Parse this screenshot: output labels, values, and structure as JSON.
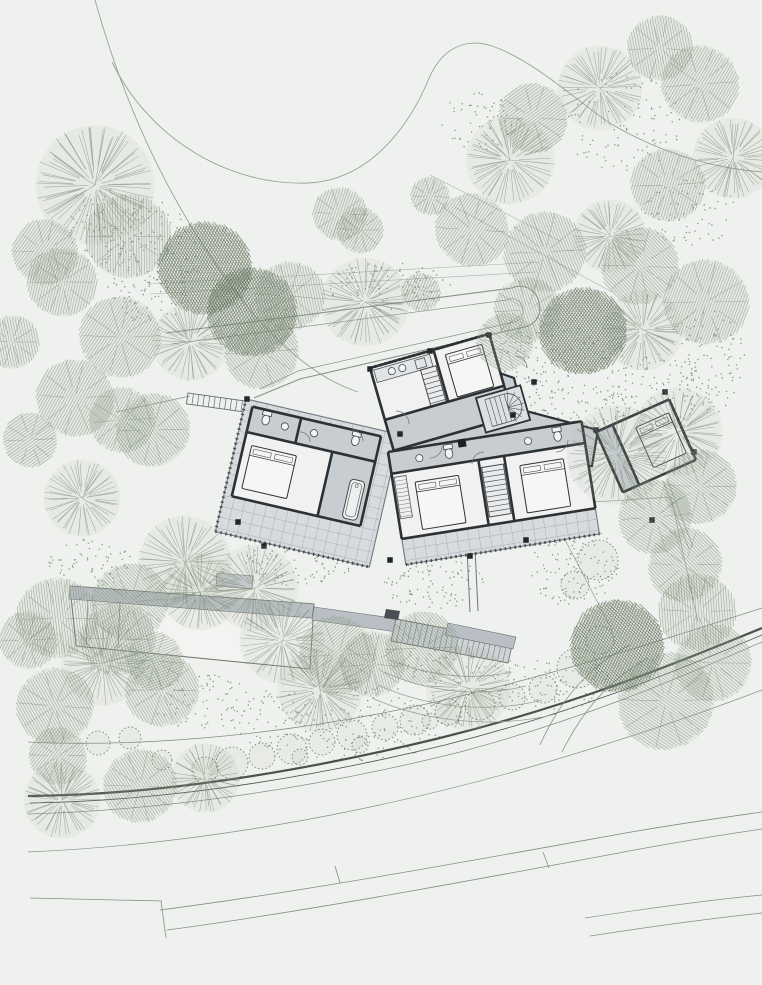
{
  "canvas": {
    "width": 762,
    "height": 985
  },
  "palette": {
    "background": "#eff1ee",
    "tree_line": "#72816e",
    "tree_dark": "#55654f",
    "tree_fill": "#aebaa8",
    "dot": "#5d6d5b",
    "contour": "#9aa09a",
    "path_line": "#8b918b",
    "road_dark": "#4b514b",
    "road_light": "#878d87",
    "wall": "#2d3134",
    "floor_white": "#f0f1f0",
    "hall_gray": "#c7cdd1",
    "terrace": "#d7dbde",
    "terrace_line": "#a7aeb3",
    "roof_gray": "#b9bfc4",
    "outline": "#6b716b"
  },
  "contours": [
    "M 95,0 C 120,90 165,205 250,310 C 288,354 322,380 358,392",
    "M 112,62 C 150,140 230,186 308,183 C 368,180 408,130 430,76 C 444,46 468,38 492,46 C 532,60 570,95 608,122 C 658,152 710,168 762,172"
  ],
  "upper_lines": [
    "M 150,284 L 540,262",
    "M 150,294 L 536,272",
    "M 430,175 L 562,242",
    "M 455,207 L 612,292"
  ],
  "driveway": {
    "outer": "M 166,333 L 512,288 A 19 19 0 0 1 539,305 L 540,309 A 19 19 0 0 1 524,327 L 300,379 L 254,398",
    "inner": "M 172,344 L 507,300 A 11 11 0 0 1 523,310 L 523,313 A 11 11 0 0 1 514,322 L 298,371 L 260,389"
  },
  "roads": [
    {
      "d": "M 28,742 C 150,748 300,733 440,701 C 560,673 660,641 762,608",
      "w": 0.8,
      "c": "road_light"
    },
    {
      "d": "M 28,796 C 160,795 300,772 440,738 C 570,706 670,666 762,628",
      "w": 2.2,
      "c": "road_dark"
    },
    {
      "d": "M 30,803 C 162,801 305,779 445,745 C 572,713 672,673 762,635",
      "w": 0.8,
      "c": "road_dark"
    },
    {
      "d": "M 28,814 C 170,810 320,787 460,752 C 580,720 675,680 762,642",
      "w": 0.7,
      "c": "road_light"
    },
    {
      "d": "M 28,852 C 190,845 360,815 520,770 C 635,737 715,708 762,690",
      "w": 0.7,
      "c": "road_light"
    },
    {
      "d": "M 160,910 C 300,892 470,861 620,834 C 670,825 720,818 762,812",
      "w": 0.8,
      "c": "road_light"
    },
    {
      "d": "M 167,930 C 310,911 490,877 640,849 C 695,839 735,833 762,829",
      "w": 0.8,
      "c": "road_light"
    },
    {
      "d": "M 30,898 L 162,901",
      "w": 0.8,
      "c": "road_light"
    },
    {
      "d": "M 161,901 L 166,938",
      "w": 0.8,
      "c": "road_light"
    },
    {
      "d": "M 335,866 L 340,883",
      "w": 0.8,
      "c": "road_light"
    },
    {
      "d": "M 543,852 L 549,868",
      "w": 0.8,
      "c": "road_light"
    },
    {
      "d": "M 585,918 C 650,908 710,900 762,895",
      "w": 0.7,
      "c": "road_light"
    },
    {
      "d": "M 590,936 C 655,926 715,918 762,913",
      "w": 0.7,
      "c": "road_light"
    },
    {
      "d": "M 540,745 C 560,700 590,665 630,645",
      "w": 0.8,
      "c": "road_light"
    },
    {
      "d": "M 562,752 C 582,712 608,680 648,658",
      "w": 0.8,
      "c": "road_light"
    }
  ],
  "boundary_lines": [
    "M 547,505 L 612,630",
    "M 671,497 L 698,622",
    "M 547,505 L 671,497",
    "M 663,481 L 689,549",
    "M 667,479 L 693,547"
  ],
  "terrace_contours": [
    "M 390,660 C 430,676 470,681 512,672",
    "M 384,672 C 430,693 482,697 526,686",
    "M 378,685 C 430,709 492,713 542,700",
    "M 372,698 C 430,724 500,728 556,714"
  ],
  "lower_building": {
    "body": [
      [
        70,
        586
      ],
      [
        314,
        604
      ],
      [
        310,
        669
      ],
      [
        76,
        646
      ]
    ],
    "roof_band": [
      [
        70,
        586
      ],
      [
        314,
        604
      ],
      [
        312,
        618
      ],
      [
        69,
        599
      ]
    ],
    "notch": [
      [
        217,
        573
      ],
      [
        253,
        576
      ],
      [
        252,
        589
      ],
      [
        216,
        586
      ]
    ],
    "link_band": [
      [
        314,
        607
      ],
      [
        399,
        619
      ],
      [
        397,
        632
      ],
      [
        312,
        620
      ]
    ],
    "dividers": [
      "M 88,600 L 86,645",
      "M 120,602 L 118,648"
    ]
  },
  "stair_terrace": {
    "grid_poly": [
      [
        396,
        619
      ],
      [
        513,
        641
      ],
      [
        508,
        663
      ],
      [
        391,
        641
      ]
    ],
    "band": [
      [
        448,
        623
      ],
      [
        516,
        637
      ],
      [
        513,
        649
      ],
      [
        445,
        635
      ]
    ],
    "wall": [
      [
        386,
        609
      ],
      [
        400,
        611
      ],
      [
        398,
        620
      ],
      [
        384,
        618
      ]
    ],
    "steps": 22
  },
  "link_path": [
    "M 467,549 L 470,612",
    "M 475,548 L 478,611"
  ],
  "walkway": {
    "x": 188,
    "y": 393,
    "rot": 8,
    "w": 64,
    "h": 11,
    "step": 5.5,
    "lead": "M 116,412 L 190,396"
  },
  "building": {
    "hall": [
      [
        392,
        398
      ],
      [
        468,
        362
      ],
      [
        514,
        378
      ],
      [
        522,
        410
      ],
      [
        598,
        430
      ],
      [
        592,
        466
      ],
      [
        470,
        472
      ],
      [
        406,
        454
      ]
    ],
    "wings": [
      {
        "name": "west-wing",
        "ox": 246,
        "oy": 399,
        "rot": 13,
        "terrace": {
          "x": 0,
          "y": 0,
          "w": 158,
          "h": 136,
          "grid": 11
        },
        "rooms": [
          {
            "x": 8,
            "y": 6,
            "w": 132,
            "h": 92,
            "fill": "floor_white"
          },
          {
            "x": 8,
            "y": 6,
            "w": 132,
            "h": 26,
            "fill": "hall_gray"
          },
          {
            "x": 96,
            "y": 32,
            "w": 44,
            "h": 66,
            "fill": "hall_gray"
          }
        ],
        "walls": [
          [
            8,
            6,
            140,
            6
          ],
          [
            8,
            6,
            8,
            98
          ],
          [
            8,
            98,
            140,
            98
          ],
          [
            140,
            6,
            140,
            98
          ],
          [
            8,
            32,
            140,
            32
          ],
          [
            96,
            32,
            96,
            98
          ],
          [
            58,
            6,
            58,
            32
          ]
        ],
        "furn": [
          {
            "t": "bed",
            "x": 16,
            "y": 44,
            "w": 46,
            "h": 44
          },
          {
            "t": "tub",
            "x": 120,
            "y": 54,
            "w": 15,
            "h": 40
          },
          {
            "t": "wc",
            "x": 24,
            "y": 16
          },
          {
            "t": "sink",
            "x": 44,
            "y": 18
          },
          {
            "t": "sink",
            "x": 74,
            "y": 18
          },
          {
            "t": "wc",
            "x": 116,
            "y": 16
          }
        ],
        "ticks": "M 0,0 L 0,136 M 0,136 L 158,136"
      },
      {
        "name": "north-wing",
        "ox": 370,
        "oy": 368,
        "rot": -16,
        "rooms": [
          {
            "x": 0,
            "y": 0,
            "w": 124,
            "h": 86,
            "fill": "floor_white"
          },
          {
            "x": 0,
            "y": 54,
            "w": 124,
            "h": 32,
            "fill": "hall_gray"
          }
        ],
        "walls": [
          [
            0,
            0,
            124,
            0
          ],
          [
            0,
            0,
            0,
            86
          ],
          [
            124,
            0,
            124,
            86
          ],
          [
            0,
            86,
            124,
            86
          ],
          [
            66,
            0,
            66,
            54
          ],
          [
            0,
            54,
            124,
            54
          ]
        ],
        "furn": [
          {
            "t": "counter",
            "x": 3,
            "y": 3,
            "w": 58,
            "h": 13
          },
          {
            "t": "sink",
            "x": 20,
            "y": 9
          },
          {
            "t": "sink",
            "x": 31,
            "y": 9
          },
          {
            "t": "rect",
            "x": 45,
            "y": 5,
            "w": 10,
            "h": 9
          },
          {
            "t": "stairs",
            "x": 48,
            "y": 16,
            "w": 16,
            "h": 38,
            "dir": "v"
          },
          {
            "t": "bed",
            "x": 76,
            "y": 8,
            "w": 38,
            "h": 44
          }
        ],
        "ticks": "M 0,0 L 124,0"
      },
      {
        "name": "south-wing",
        "ox": 388,
        "oy": 452,
        "rot": -9,
        "terrace": {
          "x": 0,
          "y": 88,
          "w": 196,
          "h": 26,
          "grid": 11
        },
        "rooms": [
          {
            "x": 0,
            "y": 0,
            "w": 196,
            "h": 88,
            "fill": "floor_white"
          },
          {
            "x": 0,
            "y": 0,
            "w": 196,
            "h": 22,
            "fill": "hall_gray"
          }
        ],
        "walls": [
          [
            0,
            0,
            196,
            0
          ],
          [
            0,
            0,
            0,
            88
          ],
          [
            196,
            0,
            196,
            88
          ],
          [
            0,
            88,
            196,
            88
          ],
          [
            0,
            22,
            196,
            22
          ],
          [
            88,
            22,
            88,
            88
          ],
          [
            114,
            22,
            114,
            88
          ]
        ],
        "furn": [
          {
            "t": "stairs",
            "x": 90,
            "y": 30,
            "w": 22,
            "h": 50,
            "dir": "v"
          },
          {
            "t": "bed",
            "x": 22,
            "y": 34,
            "w": 44,
            "h": 48
          },
          {
            "t": "bed",
            "x": 128,
            "y": 34,
            "w": 44,
            "h": 48
          },
          {
            "t": "closet",
            "x": 2,
            "y": 26,
            "w": 12,
            "h": 42
          },
          {
            "t": "sink",
            "x": 30,
            "y": 11
          },
          {
            "t": "wc",
            "x": 60,
            "y": 11
          },
          {
            "t": "sink",
            "x": 140,
            "y": 11
          },
          {
            "t": "wc",
            "x": 170,
            "y": 11
          }
        ],
        "ticks": "M 0,114 L 196,114"
      },
      {
        "name": "east-room",
        "ox": 596,
        "oy": 432,
        "rot": -24,
        "rooms": [
          {
            "x": 0,
            "y": 0,
            "w": 80,
            "h": 66,
            "fill": "floor_white"
          },
          {
            "x": 0,
            "y": 0,
            "w": 18,
            "h": 66,
            "fill": "hall_gray"
          }
        ],
        "walls": [
          [
            0,
            0,
            80,
            0
          ],
          [
            0,
            0,
            0,
            66
          ],
          [
            80,
            0,
            80,
            66
          ],
          [
            0,
            66,
            80,
            66
          ],
          [
            18,
            0,
            18,
            66
          ]
        ],
        "furn": [
          {
            "t": "bed",
            "x": 38,
            "y": 12,
            "w": 36,
            "h": 44
          }
        ],
        "ticks": "M 80,0 L 80,66"
      }
    ],
    "spiral_stair": {
      "ox": 476,
      "oy": 398,
      "rot": -16,
      "w": 46,
      "h": 36
    },
    "fireplace": {
      "x": 462,
      "y": 443,
      "s": 8,
      "rot": -9
    },
    "door_arcs": [
      "M 396,411 A 13 13 0 0 1 409,424",
      "M 352,430 A 11 11 0 0 1 363,441",
      "M 430,458 A 12 12 0 0 0 442,446",
      "M 472,464 A 12 12 0 0 1 484,452",
      "M 515,356 A 12 12 0 0 1 527,368",
      "M 556,452 A 12 12 0 0 0 568,440",
      "M 300,432 A 10 10 0 0 1 310,442"
    ],
    "columns": [
      [
        247,
        399
      ],
      [
        400,
        434
      ],
      [
        238,
        522
      ],
      [
        264,
        546
      ],
      [
        370,
        369
      ],
      [
        489,
        335
      ],
      [
        513,
        415
      ],
      [
        534,
        382
      ],
      [
        596,
        430
      ],
      [
        665,
        392
      ],
      [
        694,
        452
      ],
      [
        652,
        520
      ],
      [
        390,
        560
      ],
      [
        470,
        556
      ],
      [
        526,
        540
      ],
      [
        430,
        351
      ]
    ]
  },
  "trees": [
    [
      95,
      185,
      62,
      "radial"
    ],
    [
      45,
      252,
      34,
      "hatch"
    ],
    [
      128,
      236,
      44,
      "hatch"
    ],
    [
      205,
      268,
      48,
      "dark"
    ],
    [
      252,
      312,
      46,
      "dark"
    ],
    [
      62,
      282,
      36,
      "hatch"
    ],
    [
      120,
      337,
      42,
      "hatch"
    ],
    [
      190,
      342,
      40,
      "radial"
    ],
    [
      290,
      296,
      36,
      "hatch"
    ],
    [
      262,
      352,
      38,
      "hatch"
    ],
    [
      12,
      342,
      28,
      "hatch"
    ],
    [
      340,
      214,
      28,
      "hatch"
    ],
    [
      360,
      230,
      24,
      "hatch"
    ],
    [
      365,
      302,
      46,
      "radial"
    ],
    [
      421,
      292,
      20,
      "hatch"
    ],
    [
      430,
      196,
      20,
      "hatch"
    ],
    [
      505,
      342,
      30,
      "hatch"
    ],
    [
      510,
      160,
      46,
      "radial"
    ],
    [
      533,
      118,
      36,
      "hatch"
    ],
    [
      600,
      88,
      44,
      "radial"
    ],
    [
      660,
      48,
      34,
      "hatch"
    ],
    [
      700,
      84,
      40,
      "hatch"
    ],
    [
      733,
      158,
      42,
      "radial"
    ],
    [
      668,
      185,
      38,
      "hatch"
    ],
    [
      472,
      230,
      38,
      "hatch"
    ],
    [
      545,
      252,
      42,
      "hatch"
    ],
    [
      610,
      236,
      38,
      "radial"
    ],
    [
      640,
      266,
      40,
      "hatch"
    ],
    [
      706,
      302,
      44,
      "hatch"
    ],
    [
      643,
      330,
      42,
      "radial"
    ],
    [
      583,
      331,
      45,
      "dark"
    ],
    [
      527,
      310,
      34,
      "hatch"
    ],
    [
      75,
      398,
      40,
      "hatch"
    ],
    [
      122,
      420,
      34,
      "hatch"
    ],
    [
      153,
      430,
      38,
      "hatch"
    ],
    [
      82,
      498,
      40,
      "radial"
    ],
    [
      30,
      440,
      28,
      "hatch"
    ],
    [
      617,
      455,
      52,
      "radial"
    ],
    [
      678,
      432,
      46,
      "radial"
    ],
    [
      700,
      487,
      38,
      "hatch"
    ],
    [
      655,
      517,
      38,
      "hatch"
    ],
    [
      685,
      565,
      38,
      "hatch"
    ],
    [
      185,
      562,
      48,
      "radial"
    ],
    [
      130,
      602,
      40,
      "hatch"
    ],
    [
      57,
      618,
      42,
      "hatch"
    ],
    [
      103,
      663,
      44,
      "radial"
    ],
    [
      162,
      690,
      38,
      "hatch"
    ],
    [
      55,
      706,
      40,
      "hatch"
    ],
    [
      28,
      640,
      30,
      "hatch"
    ],
    [
      200,
      592,
      40,
      "radial"
    ],
    [
      255,
      588,
      45,
      "radial"
    ],
    [
      118,
      639,
      38,
      "hatch"
    ],
    [
      155,
      661,
      30,
      "hatch"
    ],
    [
      282,
      641,
      44,
      "radial"
    ],
    [
      338,
      655,
      40,
      "hatch"
    ],
    [
      372,
      664,
      34,
      "hatch"
    ],
    [
      320,
      690,
      44,
      "radial"
    ],
    [
      468,
      688,
      44,
      "radial"
    ],
    [
      422,
      648,
      38,
      "hatch"
    ],
    [
      617,
      646,
      48,
      "dark"
    ],
    [
      666,
      701,
      50,
      "hatch"
    ],
    [
      713,
      663,
      40,
      "hatch"
    ],
    [
      697,
      612,
      40,
      "hatch"
    ],
    [
      62,
      800,
      40,
      "radial"
    ],
    [
      140,
      786,
      38,
      "hatch"
    ],
    [
      205,
      778,
      36,
      "radial"
    ],
    [
      58,
      756,
      30,
      "hatch"
    ]
  ],
  "shrubs": [
    [
      205,
      770,
      13
    ],
    [
      232,
      763,
      16
    ],
    [
      262,
      756,
      13
    ],
    [
      292,
      749,
      15
    ],
    [
      322,
      742,
      13
    ],
    [
      352,
      735,
      15
    ],
    [
      385,
      727,
      13
    ],
    [
      415,
      720,
      15
    ],
    [
      448,
      712,
      13
    ],
    [
      480,
      705,
      15
    ],
    [
      512,
      697,
      13
    ],
    [
      543,
      689,
      14
    ],
    [
      300,
      757,
      8
    ],
    [
      360,
      745,
      8
    ],
    [
      430,
      721,
      8
    ],
    [
      98,
      743,
      12
    ],
    [
      130,
      738,
      11
    ],
    [
      162,
      760,
      10
    ],
    [
      577,
      668,
      20
    ],
    [
      600,
      640,
      14
    ],
    [
      598,
      560,
      20
    ],
    [
      575,
      585,
      14
    ]
  ],
  "dot_clusters": [
    [
      150,
      262,
      48,
      62,
      170
    ],
    [
      390,
      286,
      62,
      24,
      80
    ],
    [
      480,
      122,
      42,
      30,
      60
    ],
    [
      560,
      382,
      82,
      58,
      240
    ],
    [
      660,
      392,
      50,
      40,
      90
    ],
    [
      708,
      360,
      36,
      55,
      100
    ],
    [
      690,
      212,
      46,
      34,
      70
    ],
    [
      300,
      562,
      56,
      24,
      90
    ],
    [
      432,
      582,
      52,
      26,
      90
    ],
    [
      572,
      562,
      46,
      44,
      120
    ],
    [
      620,
      122,
      60,
      50,
      90
    ],
    [
      92,
      562,
      46,
      24,
      60
    ],
    [
      350,
      722,
      120,
      38,
      200
    ],
    [
      552,
      682,
      60,
      28,
      90
    ],
    [
      212,
      702,
      62,
      28,
      80
    ],
    [
      452,
      662,
      60,
      22,
      70
    ],
    [
      108,
      228,
      40,
      40,
      80
    ]
  ]
}
